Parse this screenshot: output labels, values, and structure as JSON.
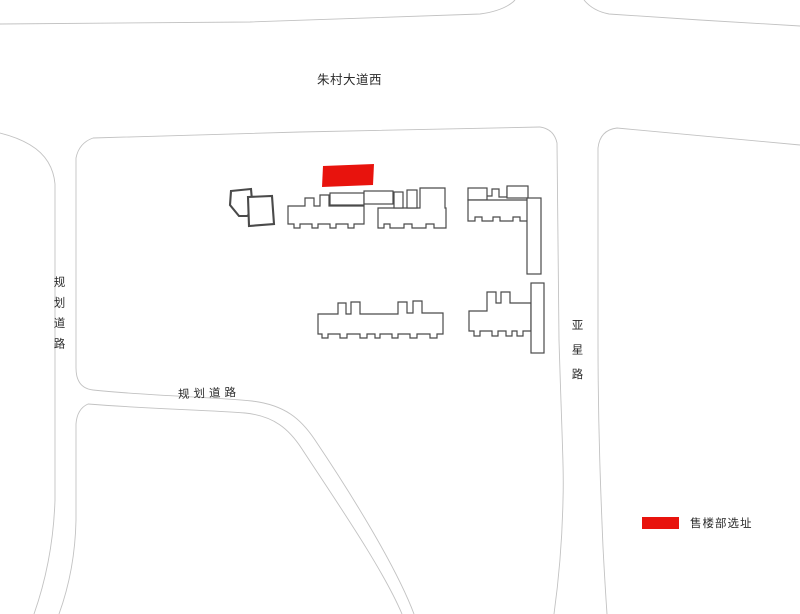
{
  "page": {
    "kind": "residential site plan",
    "background": "#ffffff"
  },
  "labels": {
    "top_road": "朱村大道西",
    "left_road": "规划道路",
    "middle_road": "规划道路",
    "right_road": "亚星路"
  },
  "legend": {
    "label": "售楼部选址"
  },
  "colors": {
    "site_red": "#e8130d",
    "road_line": "#c2c2c2",
    "building_outline": "#4a4a4a",
    "text": "#2b2b2b"
  }
}
